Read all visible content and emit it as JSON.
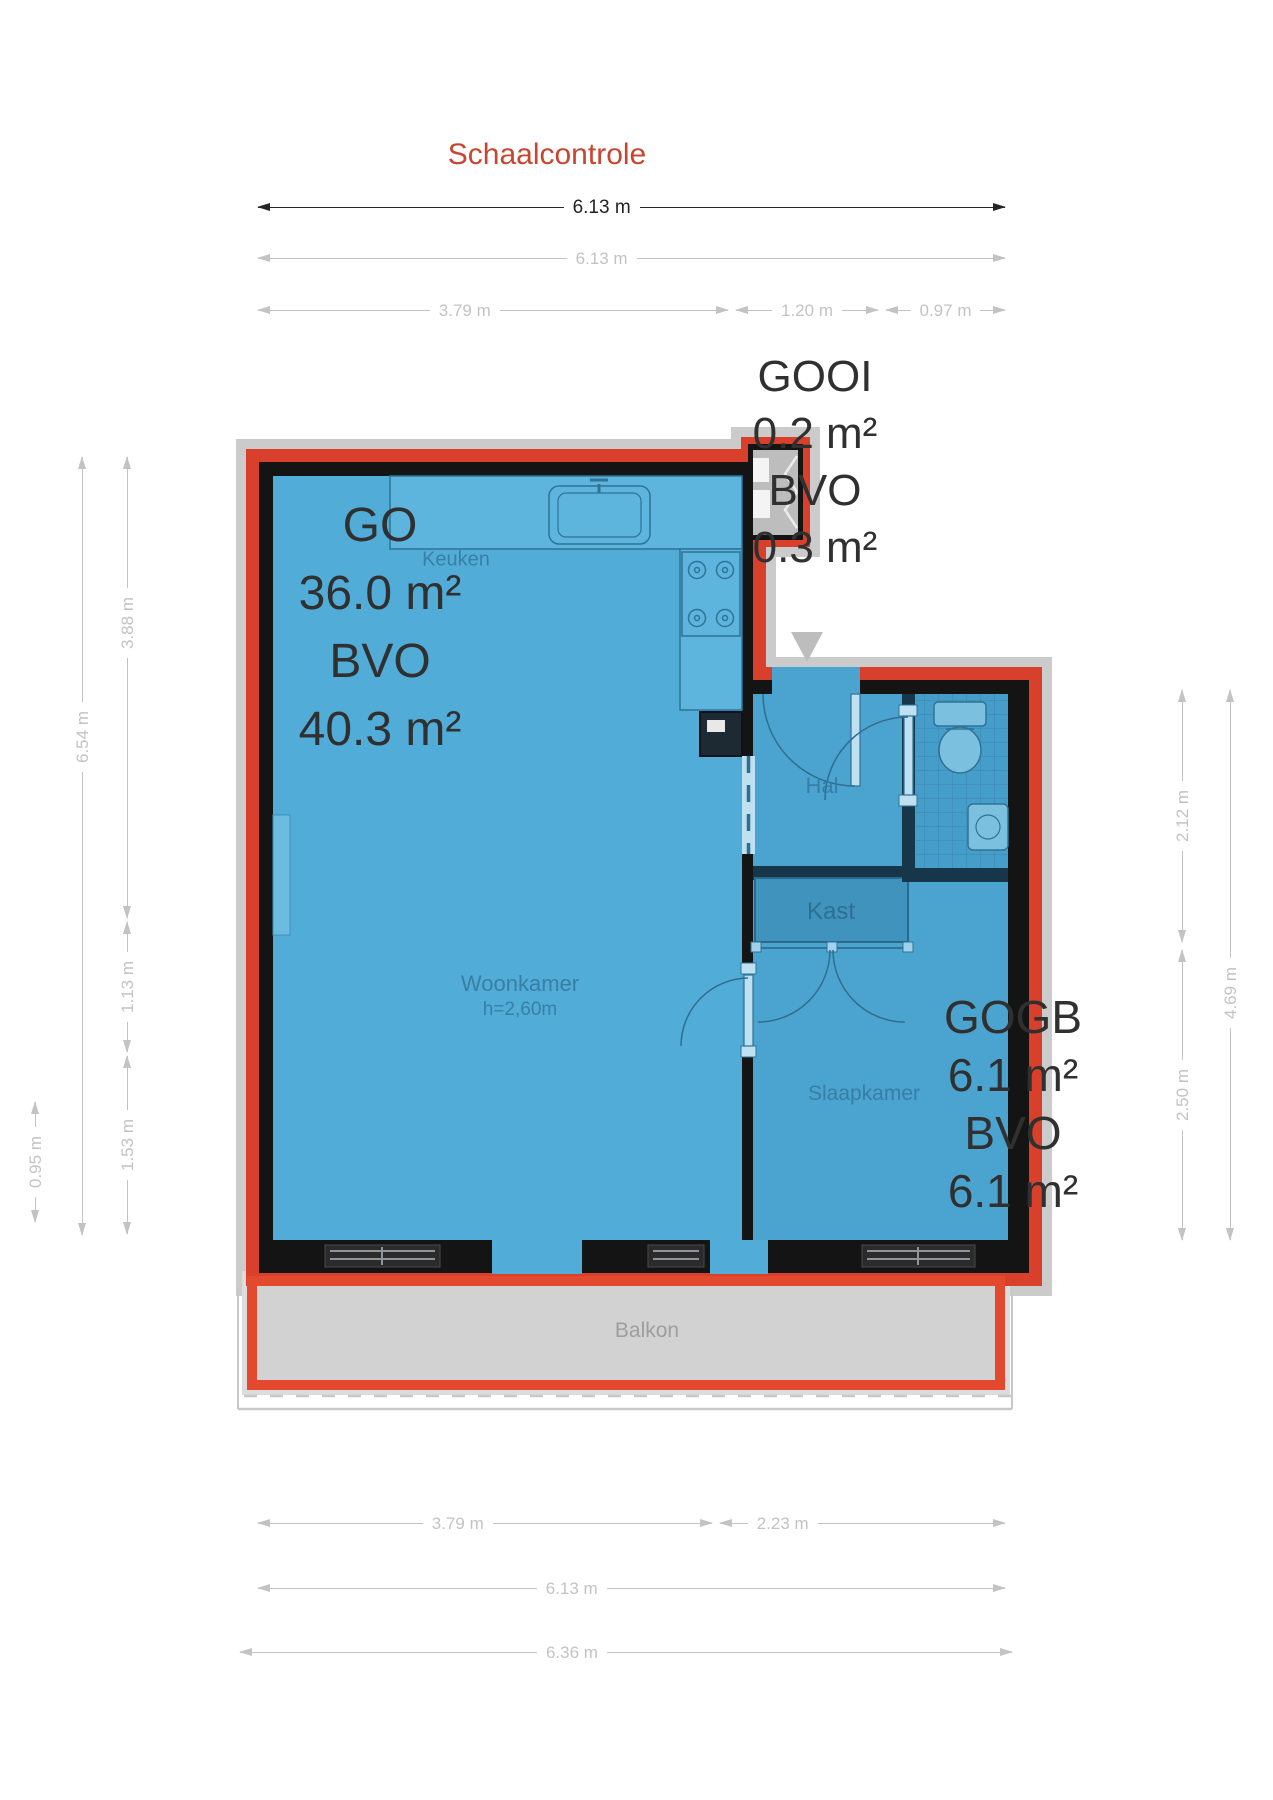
{
  "title": "Schaalcontrole",
  "plan": {
    "areas": {
      "go": {
        "line1": "GO",
        "line2": "36.0 m²",
        "line3": "BVO",
        "line4": "40.3 m²"
      },
      "gooi": {
        "line1": "GOOI",
        "line2": "0.2 m²",
        "line3": "BVO",
        "line4": "0.3 m²"
      },
      "gogb": {
        "line1": "GOGB",
        "line2": "6.1 m²",
        "line3": "BVO",
        "line4": "6.1 m²"
      }
    },
    "rooms": {
      "keuken": "Keuken",
      "hal": "Hal",
      "kast": "Kast",
      "woonkamer": "Woonkamer",
      "woonkamer_height": "h=2,60m",
      "slaapkamer": "Slaapkamer",
      "balkon": "Balkon"
    }
  },
  "dimensions": {
    "top": {
      "total_primary": "6.13 m",
      "total_secondary": "6.13 m",
      "seg_a": "3.79 m",
      "seg_b": "1.20 m",
      "seg_c": "0.97 m"
    },
    "left": {
      "total": "6.54 m",
      "seg_a": "3.88 m",
      "seg_b": "1.13 m",
      "seg_c": "1.53 m",
      "balcony_depth": "0.95 m"
    },
    "right": {
      "seg_a": "2.12 m",
      "seg_b": "2.50 m",
      "total": "4.69 m"
    },
    "bottom": {
      "seg_a": "3.79 m",
      "seg_b": "2.23 m",
      "total": "6.13 m",
      "outer_total": "6.36 m"
    }
  },
  "colors": {
    "outline_red": "#D8402B",
    "balcony_red": "#E2492F",
    "room_blue": "#52ACD8",
    "room_blue_right": "#4BA4CF",
    "wall_black": "#141414",
    "kast_blue": "#3F93BD",
    "dim_gray": "#C3C3C3",
    "dim_dark": "#252525",
    "title_red": "#C8452F",
    "shadow_gray": "#CBCBCB",
    "balcony_gray": "#D2D2D2"
  }
}
